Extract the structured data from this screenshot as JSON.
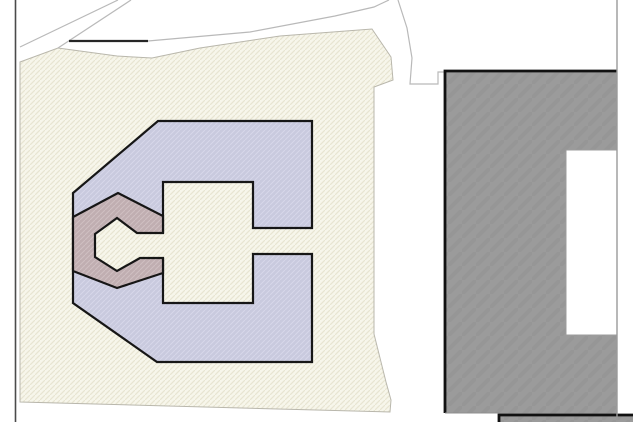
{
  "canvas": {
    "width": 633,
    "height": 422,
    "background": "#ffffff"
  },
  "colors": {
    "background": "#ffffff",
    "outline_black": "#161616",
    "building_edge_black": "#111111",
    "thin_road_line": "#b9b9b9",
    "parcel_border": "#b9b7ac",
    "west_boundary": "#4b4b4b",
    "east_boundary": "#9a9a9a",
    "notch_border": "#9c9c9c",
    "gray_bottom_thin_edge": "#8f8f8f",
    "road_black_segment": "#262626"
  },
  "patterns": {
    "cream": {
      "base": "#f7f6eb",
      "line": "#e8e5d2",
      "size": 5,
      "lw": 1.2
    },
    "lavender": {
      "base": "#c9cade",
      "line": "#d7d7e9",
      "size": 5,
      "lw": 1
    },
    "mauve": {
      "base": "#c0aeb1",
      "line": "#cfbfc1",
      "size": 5,
      "lw": 1
    },
    "gray": {
      "base": "#9b9b9b",
      "line": "#969696",
      "size": 14,
      "lw": 4
    }
  },
  "shapes": [
    {
      "name": "parcel-hatched",
      "type": "polygon",
      "fill": "pattern:cream",
      "stroke": "#b9b7ac",
      "strokeWidth": 1,
      "points": [
        [
          20,
          62
        ],
        [
          58,
          48
        ],
        [
          117,
          56
        ],
        [
          152,
          58
        ],
        [
          200,
          48
        ],
        [
          280,
          36
        ],
        [
          372,
          29
        ],
        [
          391,
          57
        ],
        [
          393,
          80
        ],
        [
          374,
          87
        ],
        [
          374,
          334
        ],
        [
          386,
          382
        ],
        [
          391,
          400
        ],
        [
          390,
          412
        ],
        [
          20,
          402
        ]
      ]
    },
    {
      "name": "road-edge-line-1",
      "type": "polyline",
      "stroke": "#b9b9b9",
      "strokeWidth": 1.2,
      "points": [
        [
          20,
          47
        ],
        [
          118,
          0
        ]
      ]
    },
    {
      "name": "road-edge-line-2",
      "type": "polyline",
      "stroke": "#b9b9b9",
      "strokeWidth": 1.2,
      "points": [
        [
          58,
          48
        ],
        [
          131,
          0
        ]
      ]
    },
    {
      "name": "road-edge-line-3",
      "type": "polyline",
      "stroke": "#b9b9b9",
      "strokeWidth": 1.2,
      "points": [
        [
          148,
          41
        ],
        [
          250,
          32
        ],
        [
          335,
          16
        ],
        [
          374,
          7
        ],
        [
          389,
          0
        ]
      ]
    },
    {
      "name": "road-edge-line-4",
      "type": "polyline",
      "stroke": "#b9b9b9",
      "strokeWidth": 1.2,
      "points": [
        [
          398,
          0
        ],
        [
          407,
          28
        ],
        [
          412,
          58
        ],
        [
          410,
          84
        ],
        [
          438,
          84
        ],
        [
          438,
          72
        ],
        [
          445,
          72
        ]
      ]
    },
    {
      "name": "road-black-segment",
      "type": "polyline",
      "stroke": "#262626",
      "strokeWidth": 2.2,
      "points": [
        [
          69,
          41
        ],
        [
          148,
          41
        ]
      ]
    },
    {
      "name": "west-boundary-line",
      "type": "line",
      "stroke": "#4b4b4b",
      "strokeWidth": 1.6,
      "points": [
        [
          15.5,
          0
        ],
        [
          15.5,
          422
        ]
      ]
    },
    {
      "name": "building-c-footprint",
      "type": "polygon",
      "fill": "pattern:lavender",
      "stroke": "#161616",
      "strokeWidth": 2.2,
      "points": [
        [
          158,
          121
        ],
        [
          312,
          121
        ],
        [
          312,
          228
        ],
        [
          253,
          228
        ],
        [
          253,
          182
        ],
        [
          163,
          182
        ],
        [
          163,
          303
        ],
        [
          253,
          303
        ],
        [
          253,
          254
        ],
        [
          312,
          254
        ],
        [
          312,
          362
        ],
        [
          157,
          362
        ],
        [
          73,
          303
        ],
        [
          73,
          193
        ]
      ]
    },
    {
      "name": "courtyard-ground-patch",
      "type": "polygon",
      "fill": "pattern:cream",
      "stroke": "none",
      "strokeWidth": 0,
      "points": [
        [
          117,
          218
        ],
        [
          95,
          234
        ],
        [
          95,
          257
        ],
        [
          117,
          271
        ],
        [
          140,
          258
        ],
        [
          166,
          258
        ],
        [
          166,
          233
        ],
        [
          137,
          233
        ]
      ]
    },
    {
      "name": "building-hex-ring",
      "type": "polygon",
      "fill": "pattern:mauve",
      "stroke": "#161616",
      "strokeWidth": 2.2,
      "points": [
        [
          118,
          193
        ],
        [
          163,
          216
        ],
        [
          163,
          233
        ],
        [
          137,
          233
        ],
        [
          117,
          218
        ],
        [
          95,
          234
        ],
        [
          95,
          257
        ],
        [
          117,
          271
        ],
        [
          140,
          258
        ],
        [
          163,
          258
        ],
        [
          163,
          273
        ],
        [
          117,
          288
        ],
        [
          73,
          271
        ],
        [
          73,
          217
        ]
      ]
    },
    {
      "name": "building-gray-footprint",
      "type": "polygon",
      "fill": "pattern:gray",
      "stroke": "none",
      "strokeWidth": 0,
      "points": [
        [
          445,
          71
        ],
        [
          617,
          71
        ],
        [
          617,
          416
        ],
        [
          499,
          416
        ],
        [
          499,
          413
        ],
        [
          445,
          413
        ]
      ]
    },
    {
      "name": "building-gray-outline",
      "type": "polyline",
      "stroke": "#111111",
      "strokeWidth": 2.8,
      "points": [
        [
          445,
          413
        ],
        [
          445,
          71
        ],
        [
          617,
          71
        ]
      ]
    },
    {
      "name": "building-gray-bottom-thin-edge",
      "type": "line",
      "stroke": "#8f8f8f",
      "strokeWidth": 1,
      "points": [
        [
          445,
          413
        ],
        [
          499,
          413
        ]
      ]
    },
    {
      "name": "gray-building-notch",
      "type": "rect",
      "fill": "#ffffff",
      "stroke": "#9c9c9c",
      "strokeWidth": 1,
      "x": 566,
      "y": 150,
      "w": 51,
      "h": 185
    },
    {
      "name": "bottom-structure",
      "type": "polygon",
      "fill": "pattern:gray",
      "stroke": "none",
      "strokeWidth": 0,
      "points": [
        [
          499,
          422
        ],
        [
          499,
          415
        ],
        [
          633,
          415
        ],
        [
          633,
          422
        ]
      ]
    },
    {
      "name": "bottom-structure-outline",
      "type": "polyline",
      "stroke": "#111111",
      "strokeWidth": 2.8,
      "points": [
        [
          499,
          422
        ],
        [
          499,
          415
        ],
        [
          633,
          415
        ]
      ]
    },
    {
      "name": "east-boundary-line",
      "type": "line",
      "stroke": "#9a9a9a",
      "strokeWidth": 1.4,
      "points": [
        [
          617,
          0
        ],
        [
          617,
          422
        ]
      ]
    }
  ]
}
